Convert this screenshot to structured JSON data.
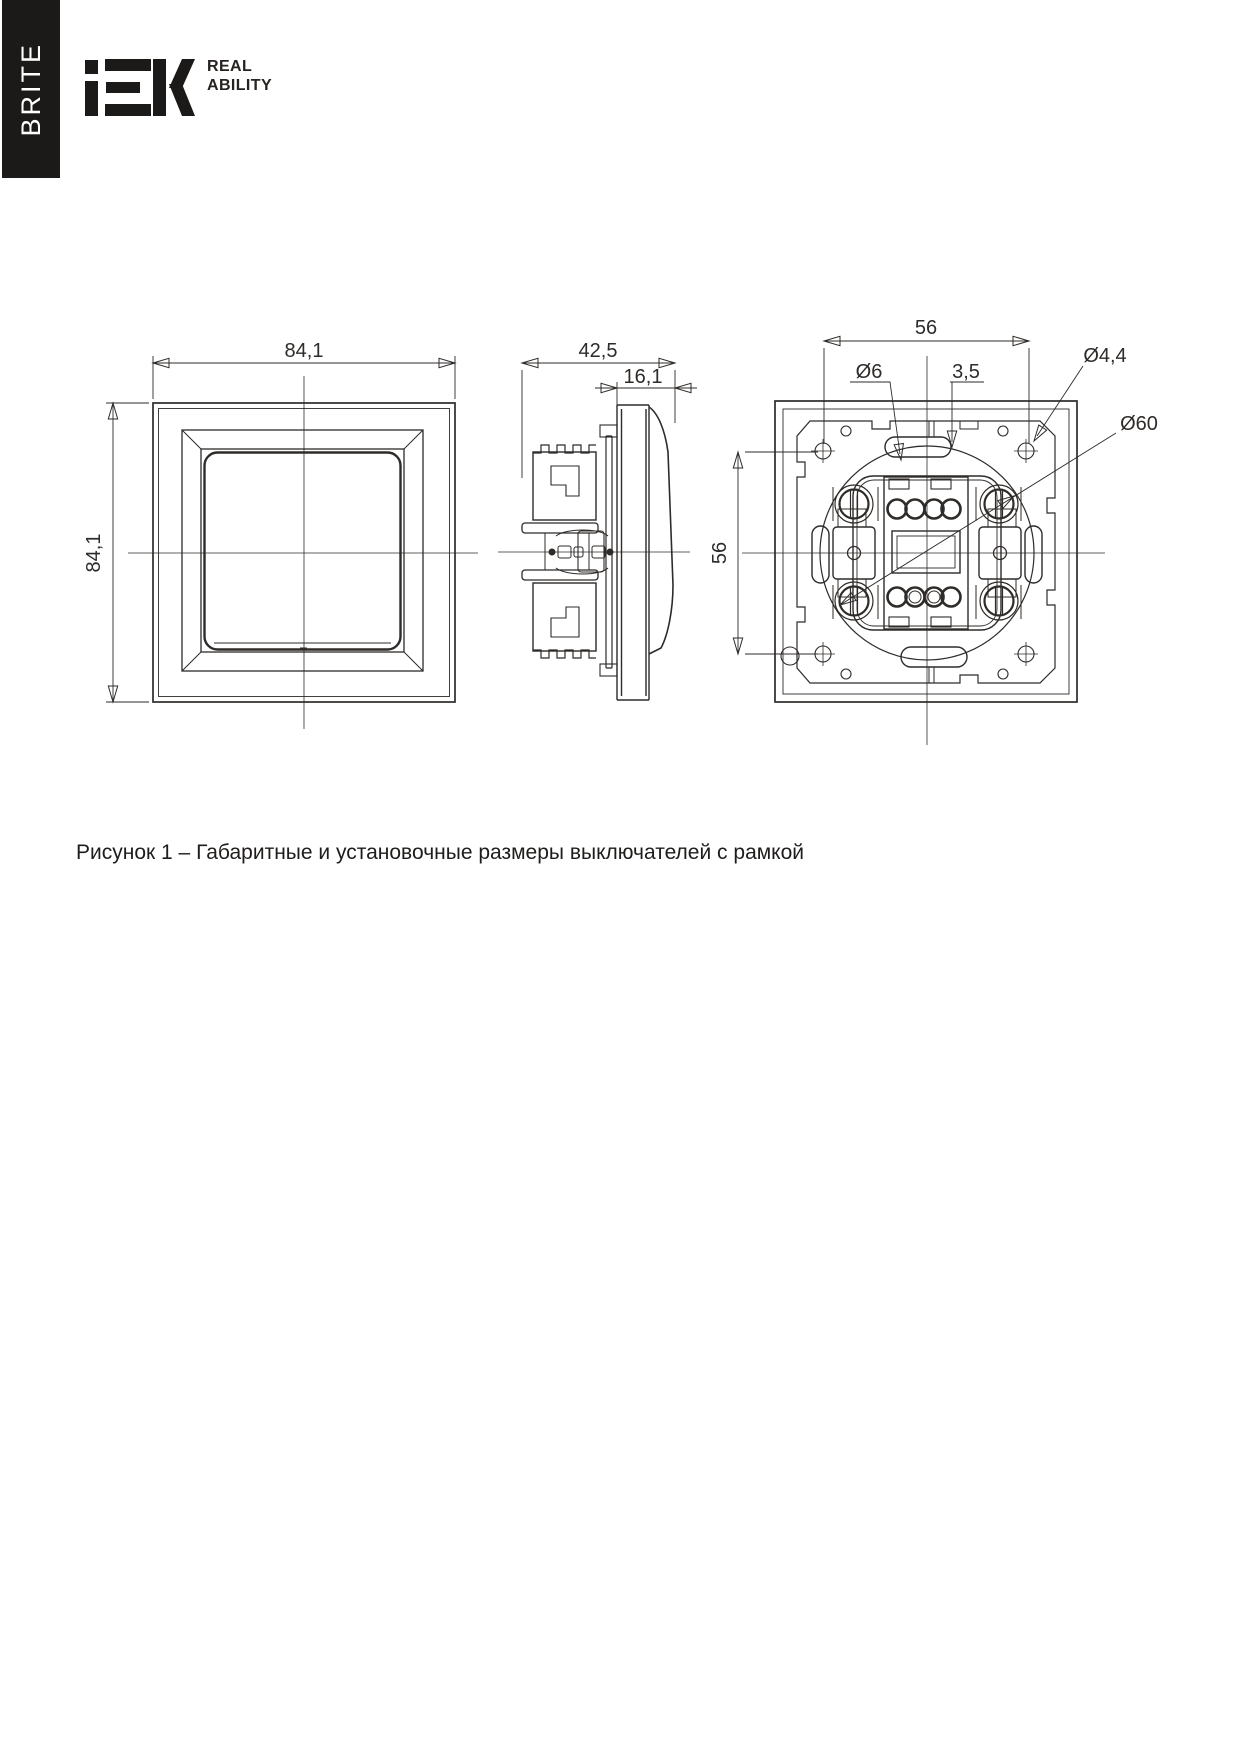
{
  "brand": {
    "series_label": "BRITE",
    "logo_text": "IEK",
    "tagline_line1": "REAL",
    "tagline_line2": "ABILITY"
  },
  "figure": {
    "caption": "Рисунок 1 – Габаритные и установочные размеры выключателей с рамкой"
  },
  "views": {
    "front": {
      "width": "84,1",
      "height": "84,1"
    },
    "side": {
      "total_depth": "42,5",
      "front_depth": "16,1"
    },
    "back": {
      "screw_spacing_h": "56",
      "screw_spacing_v": "56",
      "claw_hole_dia": "Ø6",
      "slot_width": "3,5",
      "fixing_hole_dia": "Ø4,4",
      "mount_box_dia": "Ø60"
    }
  },
  "colors": {
    "line": "#2e2b29",
    "brand_bar": "#1c1a19"
  }
}
